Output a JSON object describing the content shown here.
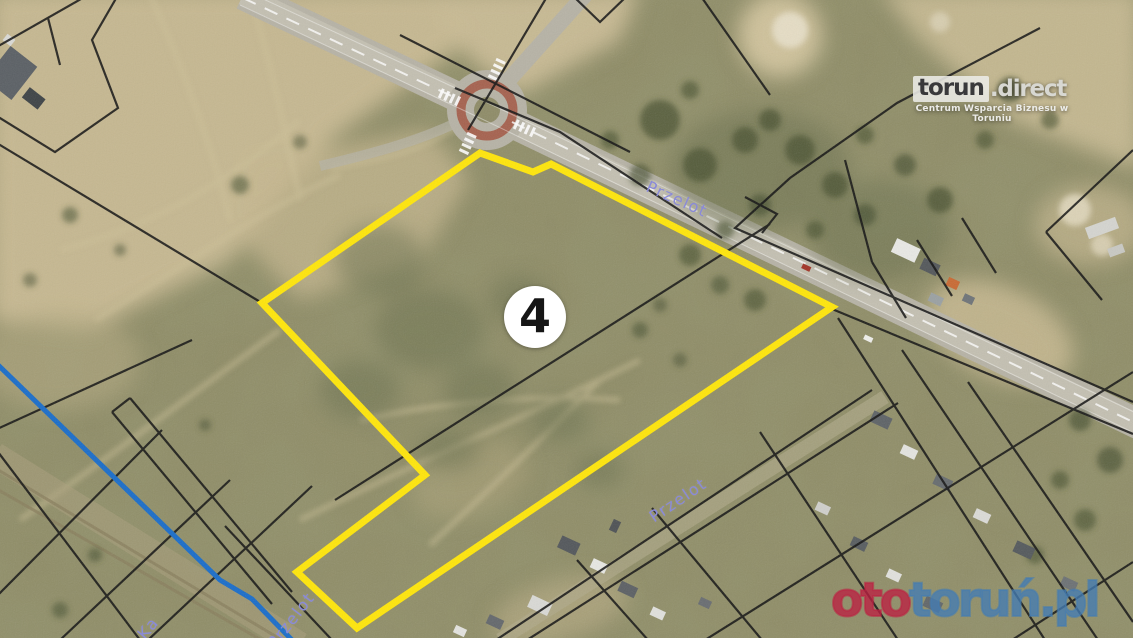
{
  "map": {
    "parcel_marker": "4",
    "street_labels": [
      {
        "text": "Przelot"
      },
      {
        "text": "Przelot"
      },
      {
        "text": "Przelot"
      },
      {
        "text": "Ka"
      }
    ],
    "colors": {
      "parcel_outline": "#ffe60a",
      "cadastral_line": "#141414",
      "utility_line": "#1a6dc9",
      "street_label": "#8a8ad8",
      "roundabout_ring": "#a3543f"
    }
  },
  "branding": {
    "logo_primary": "torun",
    "logo_rest": ".direct",
    "logo_tagline": "Centrum Wsparcia Biznesu w Toruniu"
  },
  "watermark": {
    "prefix": "oto",
    "suffix": "toruń.pl",
    "prefix_color": "#bb2142",
    "suffix_color": "#447cb3"
  }
}
